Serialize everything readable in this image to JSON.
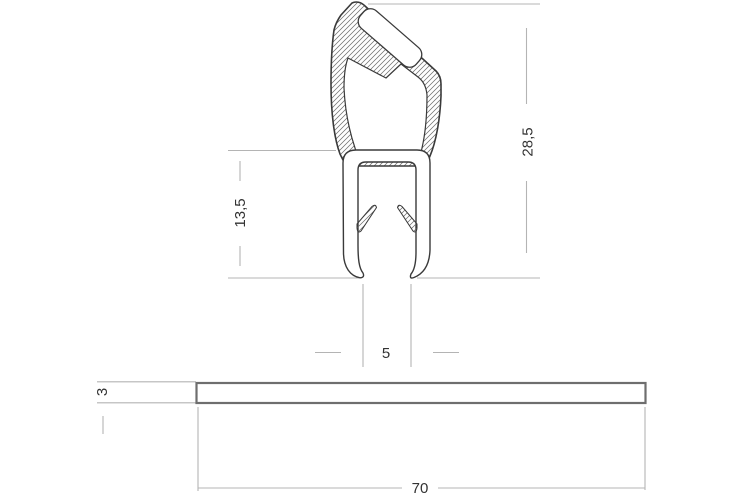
{
  "drawing": {
    "title": "seal-profile-cross-section",
    "dimensions": {
      "total_height": "28,5",
      "clamp_height": "13,5",
      "channel_gap": "5",
      "panel_thickness": "3",
      "panel_width": "70"
    },
    "colors": {
      "profile_line": "#3a3a3a",
      "dimension_line": "#b4b4b4",
      "hatch_line": "#6a6a6a",
      "panel_border": "#6e6e6e",
      "background": "#ffffff"
    }
  }
}
